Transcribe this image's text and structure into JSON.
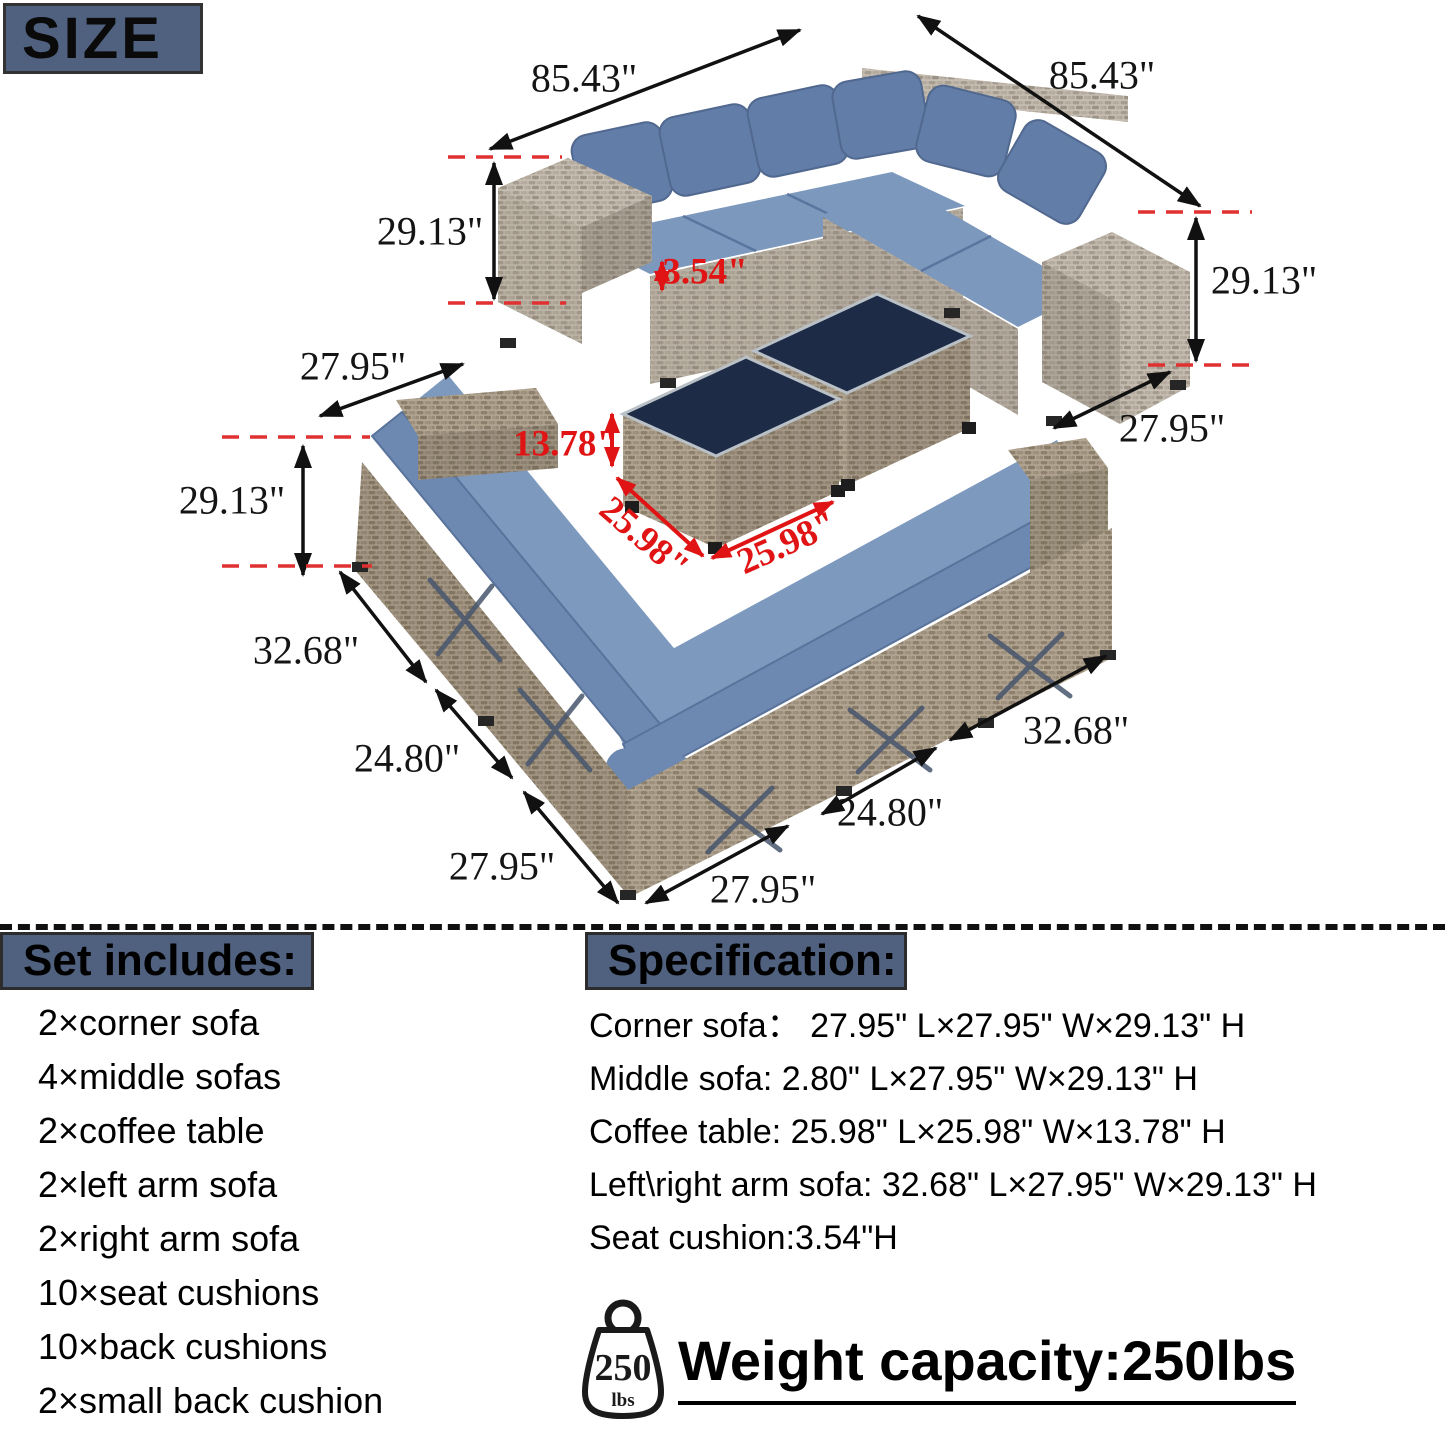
{
  "size_badge": "SIZE",
  "colors": {
    "accent_bar": "#50617f",
    "annotation_red": "#e01414",
    "annotation_black": "#141414",
    "cushion_blue": "#7d98bd",
    "back_cushion_blue": "#617da8",
    "wicker_gray": "#b5ac9f",
    "table_top_navy": "#1e2b47"
  },
  "dimensions": [
    {
      "id": "top-width-left",
      "text": "85.43\"",
      "x": 584,
      "y": 78,
      "rot": 0,
      "color": "black"
    },
    {
      "id": "top-width-right",
      "text": "85.43\"",
      "x": 1102,
      "y": 75,
      "rot": 0,
      "color": "black"
    },
    {
      "id": "top-height-left",
      "text": "29.13\"",
      "x": 430,
      "y": 231,
      "rot": 0,
      "color": "black"
    },
    {
      "id": "seat-thickness",
      "text": "3.54\"",
      "x": 705,
      "y": 272,
      "rot": 0,
      "color": "red"
    },
    {
      "id": "top-height-right",
      "text": "29.13\"",
      "x": 1264,
      "y": 280,
      "rot": 0,
      "color": "black"
    },
    {
      "id": "top-depth-left",
      "text": "27.95\"",
      "x": 353,
      "y": 366,
      "rot": 0,
      "color": "black"
    },
    {
      "id": "top-depth-right",
      "text": "27.95\"",
      "x": 1172,
      "y": 428,
      "rot": 0,
      "color": "black"
    },
    {
      "id": "coffee-table-height",
      "text": "13.78\"",
      "x": 565,
      "y": 444,
      "rot": 0,
      "color": "red"
    },
    {
      "id": "coffee-table-length",
      "text": "25.98\"",
      "x": 644,
      "y": 538,
      "rot": 41,
      "color": "red"
    },
    {
      "id": "coffee-table-width",
      "text": "25.98\"",
      "x": 787,
      "y": 543,
      "rot": -24,
      "color": "red"
    },
    {
      "id": "bottom-height-left",
      "text": "29.13\"",
      "x": 232,
      "y": 500,
      "rot": 0,
      "color": "black"
    },
    {
      "id": "bottom-arm-left",
      "text": "32.68\"",
      "x": 306,
      "y": 650,
      "rot": 0,
      "color": "black"
    },
    {
      "id": "bottom-seat-left",
      "text": "24.80\"",
      "x": 407,
      "y": 758,
      "rot": 0,
      "color": "black"
    },
    {
      "id": "bottom-depth-left",
      "text": "27.95\"",
      "x": 502,
      "y": 866,
      "rot": 0,
      "color": "black"
    },
    {
      "id": "bottom-depth-center",
      "text": "27.95\"",
      "x": 763,
      "y": 889,
      "rot": 0,
      "color": "black"
    },
    {
      "id": "bottom-seat-right",
      "text": "24.80\"",
      "x": 890,
      "y": 812,
      "rot": 0,
      "color": "black"
    },
    {
      "id": "bottom-arm-right",
      "text": "32.68\"",
      "x": 1076,
      "y": 730,
      "rot": 0,
      "color": "black"
    }
  ],
  "set_includes": {
    "title": "Set includes:",
    "items": [
      "2×corner sofa",
      "4×middle sofas",
      "2×coffee table",
      "2×left arm sofa",
      "2×right arm sofa",
      "10×seat cushions",
      "10×back cushions",
      "2×small back cushion"
    ]
  },
  "specification": {
    "title": "Specification:",
    "items": [
      "Corner sofa：  27.95\" L×27.95\" W×29.13\" H",
      "Middle sofa: 2.80\" L×27.95\" W×29.13\" H",
      "Coffee table: 25.98\" L×25.98\" W×13.78\" H",
      "Left\\right arm sofa: 32.68\" L×27.95\" W×29.13\" H",
      "Seat cushion:3.54\"H"
    ]
  },
  "weight": {
    "icon_value": "250",
    "icon_unit": "lbs",
    "label": "Weight capacity:250lbs"
  }
}
